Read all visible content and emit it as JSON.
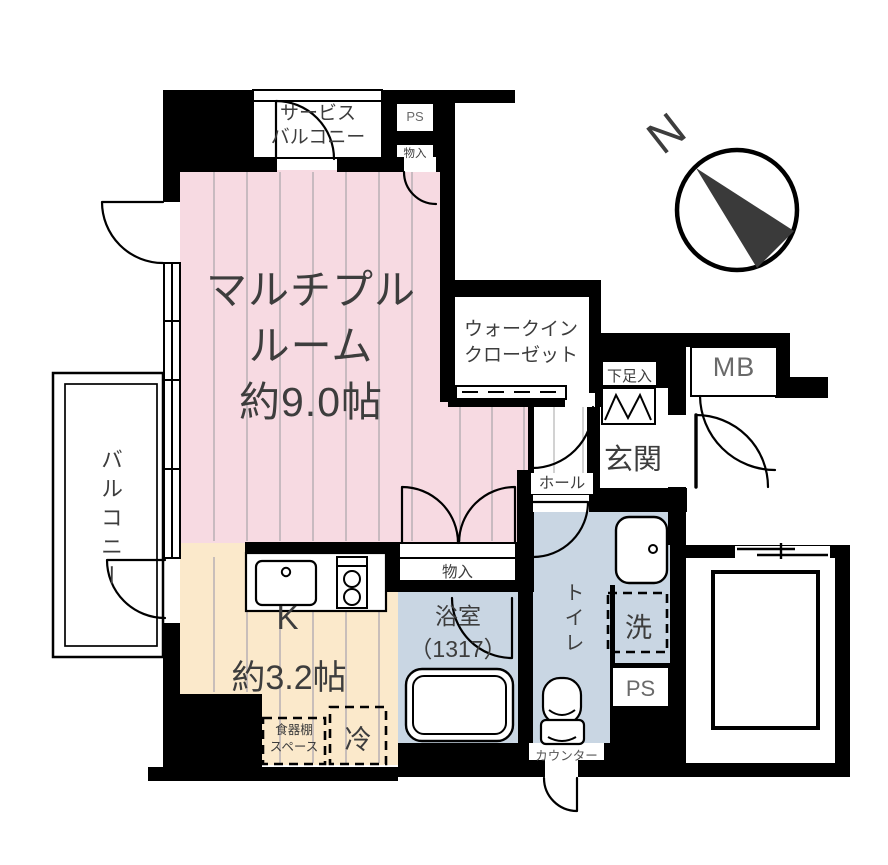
{
  "floorplan": {
    "labels": {
      "service_balcony_l1": "サービス",
      "service_balcony_l2": "バルコニー",
      "ps_top": "PS",
      "storage_top": "物入",
      "room_l1": "マルチプル",
      "room_l2": "ルーム",
      "room_l3": "約9.0帖",
      "wic_l1": "ウォークイン",
      "wic_l2": "クローゼット",
      "shoe": "下足入",
      "mb": "MB",
      "genkan": "玄関",
      "hall": "ホール",
      "balcony": "バルコニー",
      "storage_mid": "物入",
      "bath_l1": "浴室",
      "bath_l2": "（1317）",
      "toilet": "トイレ",
      "washer": "洗",
      "ps_bottom": "PS",
      "counter": "カウンター",
      "kitchen_l1": "K",
      "kitchen_l2": "約3.2帖",
      "cupboard_l1": "食器棚",
      "cupboard_l2": "スペース",
      "fridge": "冷",
      "compass_n": "N"
    },
    "colors": {
      "wall": "#000000",
      "room_pink": "#f7dae2",
      "kitchen_cream": "#fbe9cb",
      "wet_blue": "#c9d6e3",
      "floor_line": "#b8b0b4",
      "text": "#3d3d3d",
      "text_muted": "#6a6a6a",
      "compass": "#3a3a3a"
    }
  }
}
